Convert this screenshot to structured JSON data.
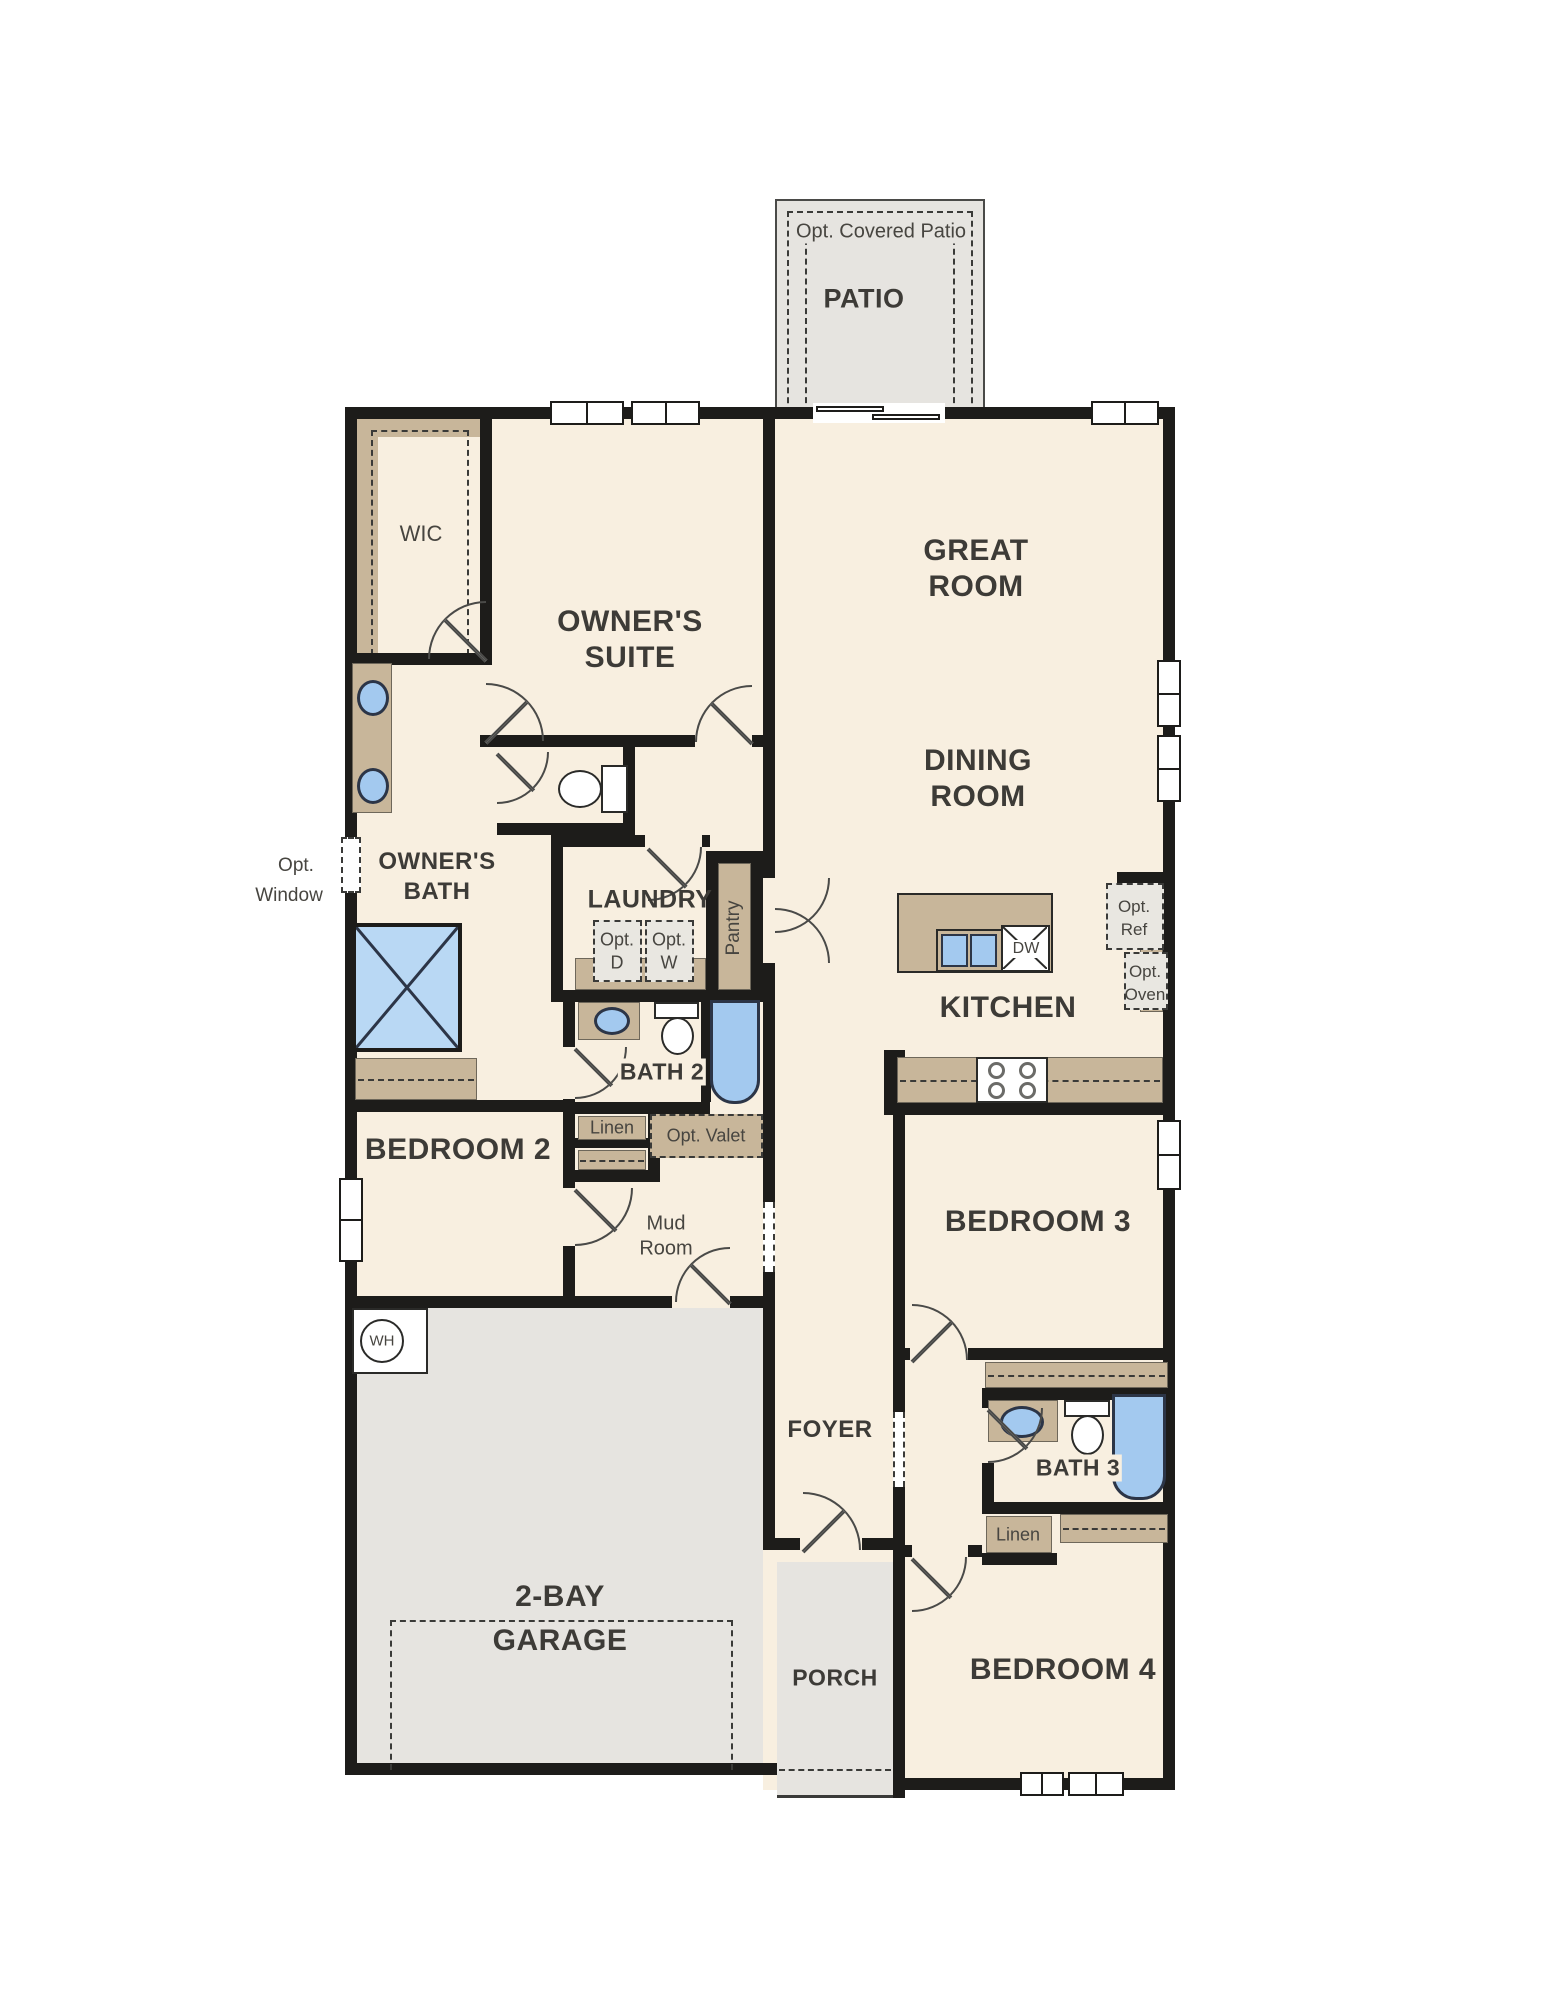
{
  "colors": {
    "wall": "#1d1c1a",
    "cream": "#f8efe0",
    "tan": "#c8b69a",
    "gray": "#e6e4e0",
    "graybox": "#e9e7e1",
    "blue": "#a3c9ef",
    "blueLight": "#b9d8f4",
    "line": "#4a4a48",
    "text": "#3d3b37",
    "textLight": "#474540"
  },
  "labels": {
    "patio_opt": "Opt. Covered Patio",
    "patio": "PATIO",
    "wic": "WIC",
    "owners_suite_1": "OWNER'S",
    "owners_suite_2": "SUITE",
    "great_room_1": "GREAT",
    "great_room_2": "ROOM",
    "dining_room_1": "DINING",
    "dining_room_2": "ROOM",
    "opt_window_1": "Opt.",
    "opt_window_2": "Window",
    "owners_bath_1": "OWNER'S",
    "owners_bath_2": "BATH",
    "laundry": "LAUNDRY",
    "pantry": "Pantry",
    "opt_d_1": "Opt.",
    "opt_d_2": "D",
    "opt_w_1": "Opt.",
    "opt_w_2": "W",
    "opt_ref_1": "Opt.",
    "opt_ref_2": "Ref",
    "opt_oven_1": "Opt.",
    "opt_oven_2": "Oven",
    "kitchen": "KITCHEN",
    "dw": "DW",
    "linen_bath2": "Linen",
    "bath2": "BATH 2",
    "opt_valet": "Opt. Valet",
    "bedroom2": "BEDROOM 2",
    "mud_room_1": "Mud",
    "mud_room_2": "Room",
    "bedroom3": "BEDROOM 3",
    "foyer": "FOYER",
    "bath3": "BATH 3",
    "linen_bath3": "Linen",
    "bedroom4": "BEDROOM 4",
    "wh": "WH",
    "garage_1": "2-BAY",
    "garage_2": "GARAGE",
    "porch": "PORCH"
  }
}
